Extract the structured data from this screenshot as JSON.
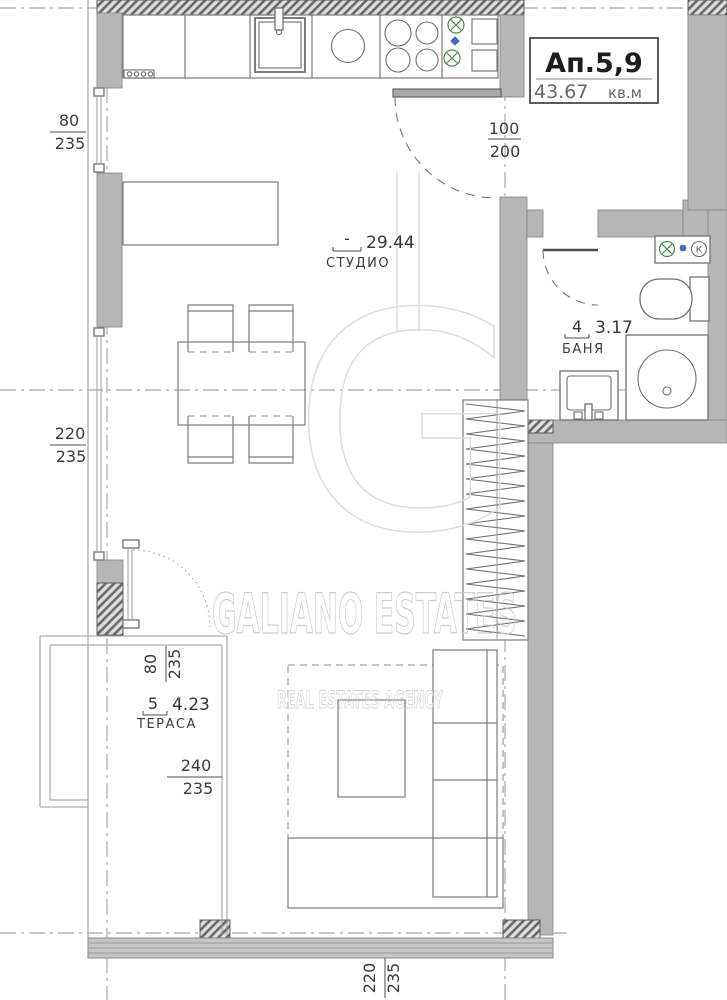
{
  "title_block": {
    "apartment": "Ап.5,9",
    "area": "43.67",
    "unit": "кв.м"
  },
  "rooms": {
    "studio": {
      "number": "-",
      "area": "29.44",
      "name": "СТУДИО"
    },
    "bathroom": {
      "number": "4",
      "area": "3.17",
      "name": "БАНЯ"
    },
    "terrace": {
      "number": "5",
      "area": "4.23",
      "name": "ТЕРАСА"
    }
  },
  "dimensions": {
    "window_left_top": {
      "width": "80",
      "height": "235"
    },
    "window_left_middle": {
      "width": "220",
      "height": "235"
    },
    "entry_door": {
      "width": "100",
      "height": "200"
    },
    "terrace_window": {
      "width": "80",
      "height": "235"
    },
    "terrace_glazing": {
      "width": "240",
      "height": "235"
    },
    "bottom_glazing": {
      "width": "220",
      "height": "235"
    }
  },
  "fixtures": {
    "valve_label": "К"
  },
  "watermark": {
    "brand": "GALIANO ESTATES",
    "tagline": "REAL ESTATES AGENCY",
    "monogram": "G"
  },
  "colors": {
    "wall_fill": "#b6b6b6",
    "line": "#4a4a4a",
    "valve_green": "#4e8a50",
    "valve_blue": "#3f6fc4",
    "watermark": "#c9c9c9"
  }
}
